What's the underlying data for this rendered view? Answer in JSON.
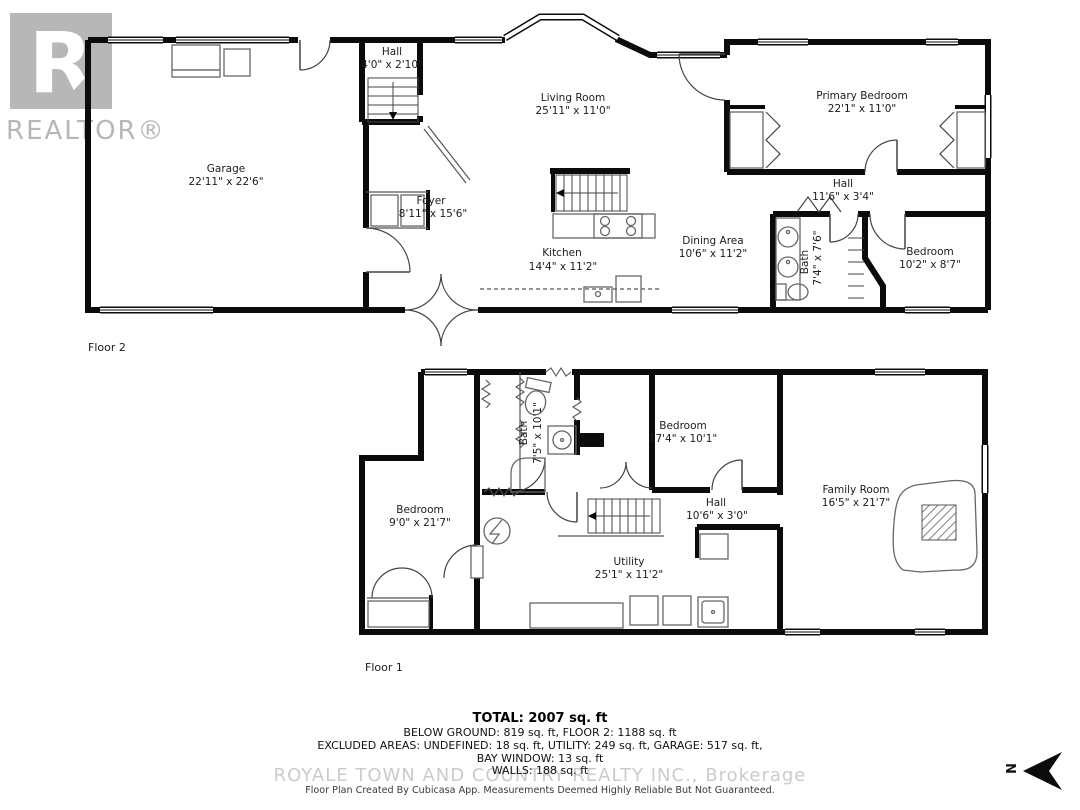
{
  "branding": {
    "logo_letter": "R",
    "logo_wordmark": "REALTOR®",
    "brokerage_watermark": "ROYALE TOWN AND COUNTRY REALTY INC., Brokerage"
  },
  "floor2": {
    "label": "Floor 2",
    "rooms": [
      {
        "name": "Hall",
        "dims": "4'0\" x 2'10\""
      },
      {
        "name": "Living Room",
        "dims": "25'11\" x 11'0\""
      },
      {
        "name": "Primary Bedroom",
        "dims": "22'1\" x 11'0\""
      },
      {
        "name": "Garage",
        "dims": "22'11\" x 22'6\""
      },
      {
        "name": "Foyer",
        "dims": "8'11\" x 15'6\""
      },
      {
        "name": "Kitchen",
        "dims": "14'4\" x 11'2\""
      },
      {
        "name": "Dining Area",
        "dims": "10'6\" x 11'2\""
      },
      {
        "name": "Hall",
        "dims": "11'6\" x 3'4\""
      },
      {
        "name": "Bath",
        "dims": "7'4\" x 7'6\""
      },
      {
        "name": "Bedroom",
        "dims": "10'2\" x 8'7\""
      }
    ]
  },
  "floor1": {
    "label": "Floor 1",
    "rooms": [
      {
        "name": "Bath",
        "dims": "7'5\" x 10'1\""
      },
      {
        "name": "Bedroom",
        "dims": "17'4\" x 10'1\""
      },
      {
        "name": "Bedroom",
        "dims": "9'0\" x 21'7\""
      },
      {
        "name": "Hall",
        "dims": "10'6\" x 3'0\""
      },
      {
        "name": "Family Room",
        "dims": "16'5\" x 21'7\""
      },
      {
        "name": "Utility",
        "dims": "25'1\" x 11'2\""
      }
    ]
  },
  "summary": {
    "total": "TOTAL: 2007 sq. ft",
    "areas_line": "BELOW GROUND: 819 sq. ft, FLOOR 2: 1188 sq. ft",
    "excluded_line": "EXCLUDED AREAS: UNDEFINED: 18 sq. ft, UTILITY: 249 sq. ft, GARAGE: 517 sq. ft,",
    "bay_window_line": "BAY WINDOW: 13 sq. ft",
    "walls_line": "WALLS: 188 sq. ft",
    "disclaimer": "Floor Plan Created By Cubicasa App. Measurements Deemed Highly Reliable But Not Guaranteed."
  },
  "compass": {
    "north_label": "N"
  },
  "icons": [
    "realtor-logo",
    "stairs-icon",
    "stove-icon",
    "sink-icon",
    "toilet-icon",
    "shower-icon",
    "fireplace-icon",
    "electrical-panel-icon",
    "washer-icon",
    "dryer-icon",
    "north-arrow-icon"
  ],
  "colors": {
    "wall": "#0b0b0b",
    "watermark_gray": "#b7b7b7",
    "label_text": "#1c1c1c",
    "fixture_gray": "#666666"
  }
}
